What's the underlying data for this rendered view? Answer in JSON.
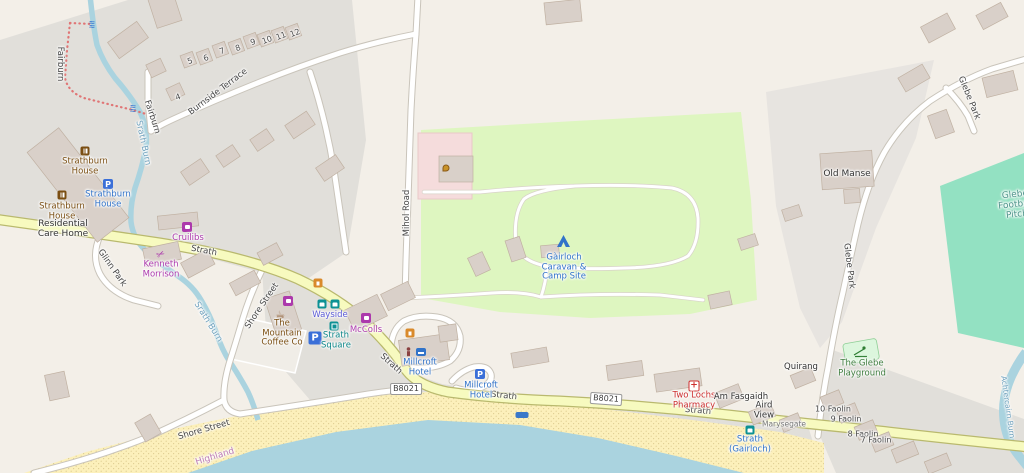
{
  "roads": {
    "strath": "Strath",
    "b8021": "B8021",
    "shore_street": "Shore Street",
    "glinn_park": "Glinn Park",
    "burnside_terrace": "Burnside Terrace",
    "mihol_road": "Mihol Road",
    "fairburn": "Fairburn",
    "glebe_park": "Glebe Park"
  },
  "water": {
    "srath_burn": "Srath Burn",
    "achtercairn_burn": "Achtercairn Burn",
    "admin_area": "Highland"
  },
  "places": {
    "strathburn_house": "Strathburn House",
    "residential_care_home": "Residential Care Home",
    "cruilibs": "Cruilibs",
    "kenneth_morrison": "Kenneth Morrison",
    "mountain_coffee": "The Mountain Coffee Co",
    "wayside": "Wayside",
    "mccolls": "McColls",
    "strath_square": "Strath Square",
    "millcroft_hotel": "Millcroft Hotel",
    "camp_site": "Gàirloch Caravan & Camp Site",
    "two_lochs_pharmacy": "Two Lochs Pharmacy",
    "am_fasgaidh": "Am Fasgaidh",
    "aird_view": "Aird View",
    "marysegate": "Marysegate",
    "strath_gairloch_stop": "Strath (Gairloch)",
    "quirang": "Quirang",
    "glebe_playground": "The Glebe Playground",
    "old_manse": "Old Manse",
    "glebe_football_pitch": "Glebe Football Pitch"
  },
  "house_numbers": [
    "4",
    "5",
    "6",
    "7",
    "8",
    "9",
    "10",
    "11",
    "12"
  ],
  "addresses": [
    "10 Faolin",
    "9 Faolin",
    "8 Faolin",
    "7 Faolin"
  ],
  "icons": {
    "parking": "P",
    "pharmacy_cross": "+",
    "wave": "≈",
    "scissors": "✂",
    "cafe": "☕"
  },
  "colors": {
    "base": "#f3efe8",
    "residential": "#e1dfda",
    "building": "#d9d0c9",
    "secondary_road": "#f7fabf",
    "minor_road": "#ffffff",
    "water": "#aad3df",
    "beach": "#fcf0bb",
    "campsite": "#def6c0",
    "pitch": "#93e1c2",
    "playground": "#dcf6dd",
    "emergency_area": "#f5dcdc",
    "poi_purple": "#ac39ac",
    "poi_blue": "#3173c9",
    "poi_brown": "#7a4e12",
    "poi_teal": "#0d9194",
    "poi_red": "#cc2f2f",
    "poi_green": "#3f7d3f"
  }
}
